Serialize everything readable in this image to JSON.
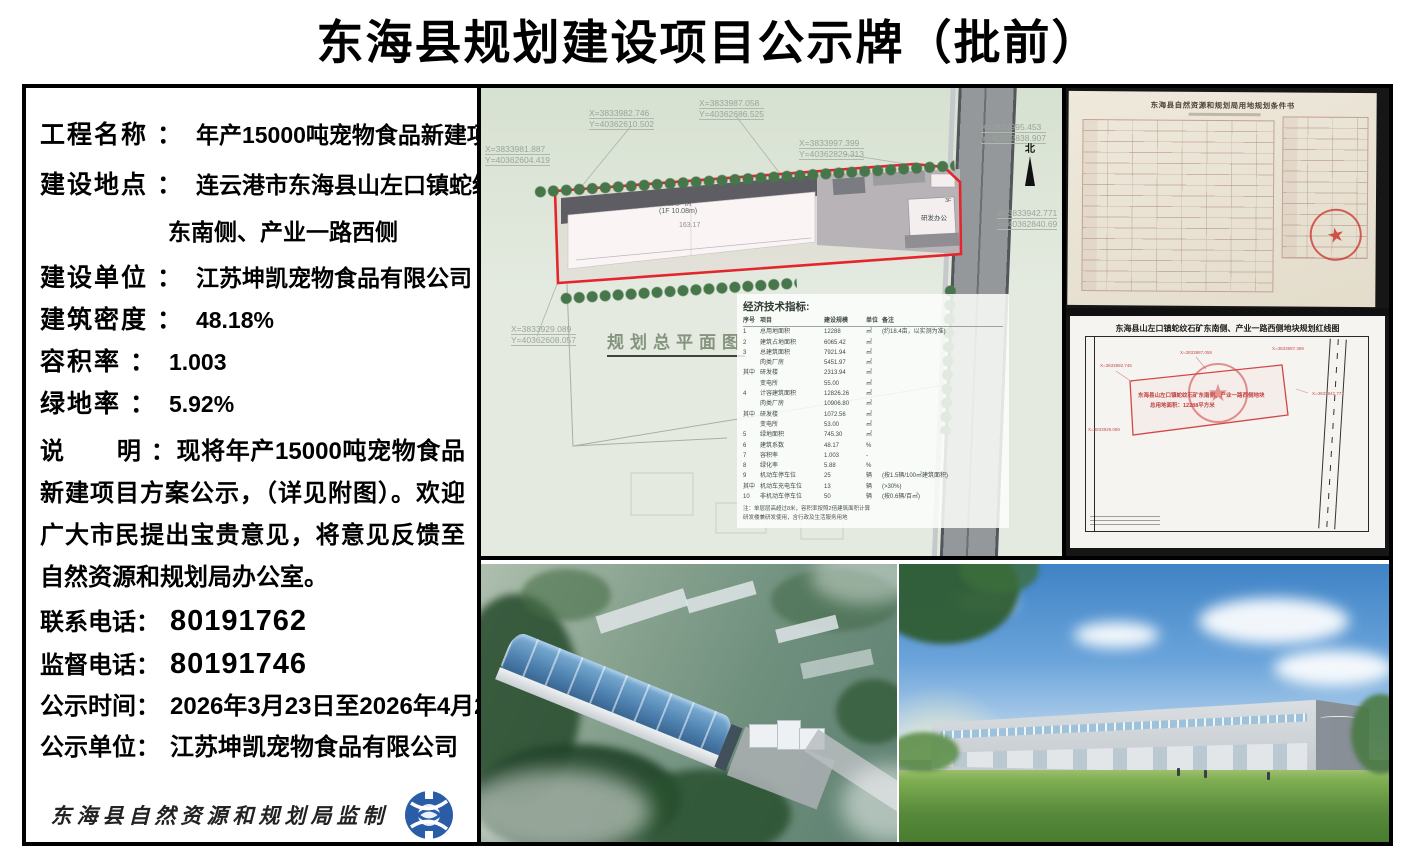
{
  "title": "东海县规划建设项目公示牌（批前）",
  "info": {
    "rows": [
      {
        "label": "工程名称 ：",
        "value": "年产15000吨宠物食品新建项目"
      },
      {
        "label": "建设地点 ：",
        "value": "连云港市东海县山左口镇蛇纹石矿"
      },
      {
        "label": "",
        "value": "东南侧、产业一路西侧"
      },
      {
        "label": "建设单位 ：",
        "value": "江苏坤凯宠物食品有限公司"
      },
      {
        "label": "建筑密度 ：",
        "value": "48.18%"
      },
      {
        "label": "容积率 ：",
        "value": "1.003"
      },
      {
        "label": "绿地率 ：",
        "value": "5.92%"
      }
    ],
    "note_label": "说　　明 ：",
    "note_text": "现将年产15000吨宠物食品新建项目方案公示，（详见附图）。欢迎广大市民提出宝贵意见，将意见反馈至自然资源和规划局办公室。",
    "contacts": [
      {
        "label": "联系电话：",
        "value": "80191762"
      },
      {
        "label": "监督电话：",
        "value": "80191746"
      },
      {
        "label": "公示时间：",
        "value": "2026年3月23日至2026年4月2日"
      },
      {
        "label": "公示单位：",
        "value": "江苏坤凯宠物食品有限公司"
      }
    ],
    "seal_text": "东海县自然资源和规划局监制"
  },
  "site_plan": {
    "caption": "规划总平面图",
    "north_label": "北",
    "factory_label": "肉类厂房",
    "factory_sub": "(1F 10.08m)",
    "factory_length": "163.17",
    "office_label": "研发办公",
    "office_floors": "3F",
    "coords": [
      {
        "x": "X=3833982.746",
        "y": "Y=40362610.502"
      },
      {
        "x": "X=3833987.058",
        "y": "Y=40362686.525"
      },
      {
        "x": "X=3833997.399",
        "y": "Y=40362829.313"
      },
      {
        "x": "X=3833995.453",
        "y": "Y=40362838.907"
      },
      {
        "x": "X=3833981.887",
        "y": "Y=40362604.419"
      },
      {
        "x": "X=3833929.089",
        "y": "Y=40362608.057"
      },
      {
        "x": "X=3833942.771",
        "y": "Y=40362840.69"
      }
    ],
    "indicators": {
      "title": "经济技术指标:",
      "headers": [
        "序号",
        "项目",
        "建设规模",
        "单位",
        "备注"
      ],
      "rows": [
        [
          "1",
          "总用地面积",
          "12288",
          "㎡",
          "(约18.4亩，以实测为准)"
        ],
        [
          "2",
          "建筑占地面积",
          "6065.42",
          "㎡",
          ""
        ],
        [
          "3",
          "总建筑面积",
          "7921.94",
          "㎡",
          ""
        ],
        [
          "",
          "肉类厂房",
          "5451.97",
          "㎡",
          ""
        ],
        [
          "其中",
          "研发楼",
          "2313.94",
          "㎡",
          ""
        ],
        [
          "",
          "变电所",
          "55.00",
          "㎡",
          ""
        ],
        [
          "4",
          "计容建筑面积",
          "12826.26",
          "㎡",
          ""
        ],
        [
          "",
          "肉类厂房",
          "10906.80",
          "㎡",
          ""
        ],
        [
          "其中",
          "研发楼",
          "1072.56",
          "㎡",
          ""
        ],
        [
          "",
          "变电所",
          "53.00",
          "㎡",
          ""
        ],
        [
          "5",
          "绿地面积",
          "745.30",
          "㎡",
          ""
        ],
        [
          "6",
          "建筑系数",
          "48.17",
          "%",
          ""
        ],
        [
          "7",
          "容积率",
          "1.003",
          "-",
          ""
        ],
        [
          "8",
          "绿化率",
          "5.88",
          "%",
          ""
        ],
        [
          "9",
          "机动车停车位",
          "25",
          "辆",
          "(按1.5辆/100㎡建筑面积)"
        ],
        [
          "其中",
          "机动车充电车位",
          "13",
          "辆",
          "(>30%)"
        ],
        [
          "10",
          "非机动车停车位",
          "50",
          "辆",
          "(按0.6辆/百㎡)"
        ]
      ],
      "notes": [
        "注：单层层高超过8米，容积率按照2倍建筑面积计算",
        "研发楼兼研发使用，含行政及生活服务用地"
      ]
    }
  },
  "documents": {
    "conditions_title": "东海县自然资源和规划局用地规划条件书",
    "redline_title": "东海县山左口镇蛇纹石矿东南侧、产业一路西侧地块规划红线图",
    "redline_parcel_line1": "东海县山左口镇蛇纹石矿东南侧、产业一路西侧地块",
    "redline_parcel_line2": "总用地面积：12288平方米",
    "seal_star": "★"
  },
  "colors": {
    "accent_red": "#e4262c",
    "logo_blue": "#2b5ca8",
    "plan_bg": "#e4eae0"
  }
}
